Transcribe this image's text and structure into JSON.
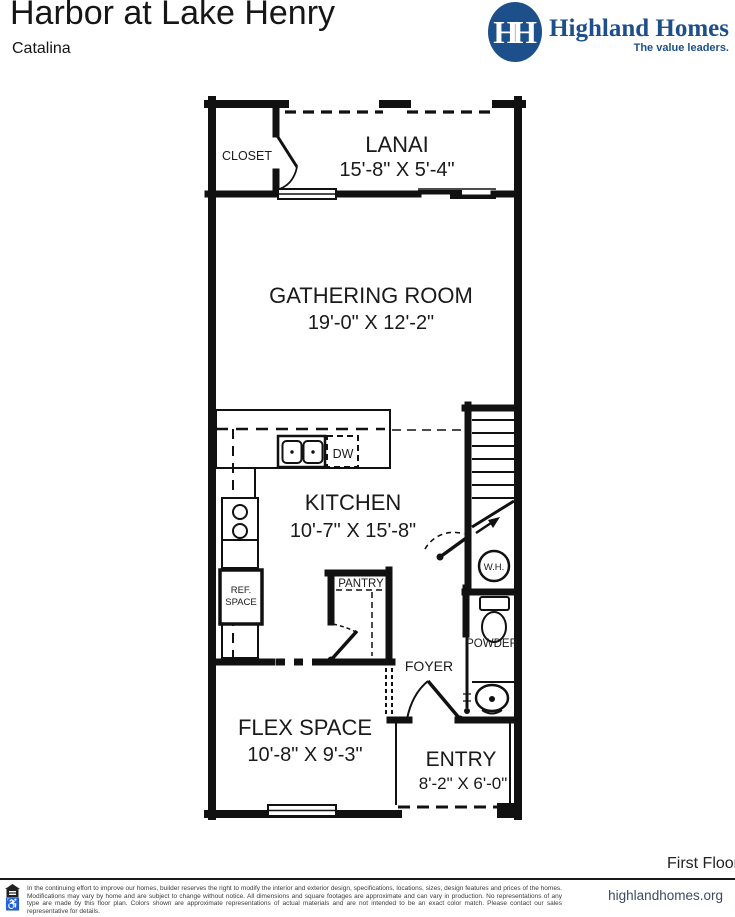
{
  "header": {
    "title": "Harbor at Lake Henry",
    "subtitle": "Catalina"
  },
  "logo": {
    "monogram": "HH",
    "name": "Highland Homes",
    "tagline": "The value leaders.",
    "brand_color": "#1d4f8a"
  },
  "plan": {
    "closet": "CLOSET",
    "lanai": {
      "name": "LANAI",
      "dims": "15'-8\" X 5'-4\""
    },
    "gathering": {
      "name": "GATHERING ROOM",
      "dims": "19'-0\" X 12'-2\""
    },
    "kitchen": {
      "name": "KITCHEN",
      "dims": "10'-7\" X 15'-8\""
    },
    "dw": "DW",
    "wh": "W.H.",
    "powder": "POWDER",
    "pantry": "PANTRY",
    "ref1": "REF.",
    "ref2": "SPACE",
    "foyer": "FOYER",
    "flex": {
      "name": "FLEX SPACE",
      "dims": "10'-8\" X 9'-3\""
    },
    "entry": {
      "name": "ENTRY",
      "dims": "8'-2\" X 6'-0\""
    }
  },
  "footer": {
    "floor_label": "First Floor",
    "website": "highlandhomes.org",
    "disclaimer": "In the continuing effort to improve our homes, builder reserves the right to modify the interior and exterior design, specifications, locations, sizes, design features and prices of the homes. Modifications may vary by home and are subject to change without notice. All dimensions and square footages are approximate and can vary in production. No representations of any type are made by this floor plan. Colors shown are approximate representations of actual materials and are not intended to be an exact color match. Please contact our sales representative for details."
  }
}
